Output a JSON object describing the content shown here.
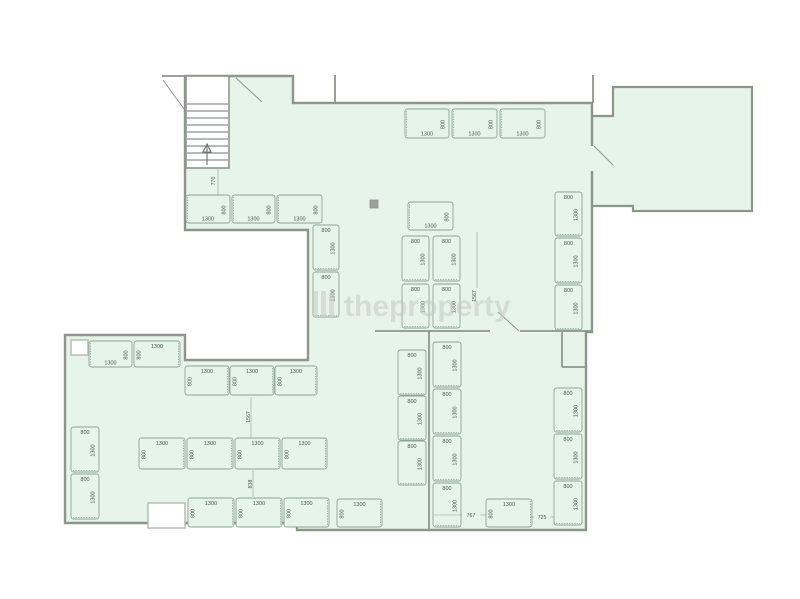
{
  "page": {
    "background": "#ffffff",
    "width": 800,
    "height": 599
  },
  "colors": {
    "floor": "#e6f4e9",
    "wall": "#8e958d",
    "wall_light": "#b4b9b1",
    "desk_stroke": "#8fa396",
    "label": "#4a5a50",
    "stair_line": "#6d7570",
    "watermark": "#c7cbc5",
    "column_fill": "#97a29b",
    "white": "#ffffff"
  },
  "watermark": {
    "text": "theproperty",
    "x": 344,
    "y": 316,
    "font_size": 30,
    "opacity": 0.55,
    "bars": [
      [
        313,
        291,
        5,
        26
      ],
      [
        321,
        291,
        5,
        26
      ],
      [
        329,
        293,
        5,
        24
      ]
    ]
  },
  "floorplan": {
    "main_outline": [
      [
        185,
        76
      ],
      [
        293,
        76
      ],
      [
        293,
        103
      ],
      [
        592,
        103
      ],
      [
        592,
        332
      ],
      [
        586,
        332
      ],
      [
        586,
        530
      ],
      [
        297,
        530
      ],
      [
        297,
        523
      ],
      [
        65,
        523
      ],
      [
        65,
        335
      ],
      [
        185,
        335
      ],
      [
        185,
        360
      ],
      [
        308,
        360
      ],
      [
        308,
        230
      ],
      [
        185,
        230
      ]
    ],
    "annex_outline": [
      [
        590,
        116
      ],
      [
        613,
        116
      ],
      [
        613,
        87
      ],
      [
        752,
        87
      ],
      [
        752,
        211
      ],
      [
        633,
        211
      ],
      [
        633,
        206
      ],
      [
        590,
        206
      ]
    ],
    "interior_walls": [
      [
        375,
        331,
        490,
        331
      ],
      [
        520,
        331,
        592,
        331
      ],
      [
        429,
        332,
        429,
        530
      ],
      [
        562,
        332,
        562,
        367
      ],
      [
        562,
        367,
        586,
        367
      ],
      [
        335,
        75,
        335,
        103
      ],
      [
        593,
        75,
        593,
        103
      ],
      [
        162,
        76,
        185,
        76
      ]
    ],
    "door_gap": {
      "x": 587,
      "y": 146,
      "w": 8,
      "h": 25
    },
    "doors": [
      [
        163,
        80,
        184,
        109
      ],
      [
        236,
        78,
        262,
        102
      ],
      [
        594,
        146,
        613,
        165
      ],
      [
        519,
        331,
        498,
        312
      ]
    ],
    "stairs": {
      "x": 186,
      "y": 76,
      "w": 43,
      "h": 92,
      "treads_from": 104,
      "tread_step": 7,
      "tread_count": 9,
      "arrow_x": 207,
      "arrow_y_tail": 165,
      "arrow_y_head": 146
    },
    "cutouts": [
      {
        "x": 148,
        "y": 503,
        "w": 37,
        "h": 25
      },
      {
        "x": 71,
        "y": 340,
        "w": 17,
        "h": 15
      }
    ],
    "column": {
      "x": 370,
      "y": 200,
      "w": 8,
      "h": 8
    },
    "desks": [
      {
        "x": 186,
        "y": 195,
        "w": 44,
        "h": 28,
        "o": "h",
        "lp": "bottom",
        "sp": "right",
        "l": "1300",
        "s": "800"
      },
      {
        "x": 232,
        "y": 195,
        "w": 43,
        "h": 28,
        "o": "h",
        "lp": "bottom",
        "sp": "right",
        "l": "1300",
        "s": "800"
      },
      {
        "x": 277,
        "y": 195,
        "w": 45,
        "h": 28,
        "o": "h",
        "lp": "bottom",
        "sp": "right",
        "l": "1300",
        "s": "800"
      },
      {
        "x": 405,
        "y": 109,
        "w": 44,
        "h": 29,
        "o": "h",
        "lp": "bottom",
        "sp": "right",
        "l": "1300",
        "s": "800"
      },
      {
        "x": 452,
        "y": 109,
        "w": 45,
        "h": 29,
        "o": "h",
        "lp": "bottom",
        "sp": "right",
        "l": "1300",
        "s": "800"
      },
      {
        "x": 500,
        "y": 109,
        "w": 45,
        "h": 29,
        "o": "h",
        "lp": "bottom",
        "sp": "right",
        "l": "1300",
        "s": "800"
      },
      {
        "x": 408,
        "y": 202,
        "w": 45,
        "h": 28,
        "o": "h",
        "lp": "bottom",
        "sp": "right",
        "l": "1300",
        "s": "800"
      },
      {
        "x": 89,
        "y": 341,
        "w": 43,
        "h": 26,
        "o": "h",
        "lp": "bottom",
        "sp": "right",
        "l": "1300",
        "s": "800"
      },
      {
        "x": 134,
        "y": 341,
        "w": 46,
        "h": 26,
        "o": "h",
        "lp": "top",
        "sp": "left",
        "l": "1300",
        "s": "800"
      },
      {
        "x": 185,
        "y": 366,
        "w": 44,
        "h": 29,
        "o": "h",
        "lp": "top",
        "sp": "left",
        "l": "1300",
        "s": "800"
      },
      {
        "x": 230,
        "y": 366,
        "w": 44,
        "h": 29,
        "o": "h",
        "lp": "top",
        "sp": "left",
        "l": "1300",
        "s": "800"
      },
      {
        "x": 275,
        "y": 366,
        "w": 42,
        "h": 29,
        "o": "h",
        "lp": "top",
        "sp": "left",
        "l": "1300",
        "s": "800"
      },
      {
        "x": 139,
        "y": 438,
        "w": 46,
        "h": 31,
        "o": "h",
        "lp": "top",
        "sp": "left",
        "l": "1300",
        "s": "800"
      },
      {
        "x": 187,
        "y": 438,
        "w": 46,
        "h": 31,
        "o": "h",
        "lp": "top",
        "sp": "left",
        "l": "1300",
        "s": "800"
      },
      {
        "x": 235,
        "y": 438,
        "w": 45,
        "h": 31,
        "o": "h",
        "lp": "top",
        "sp": "left",
        "l": "1300",
        "s": "800"
      },
      {
        "x": 282,
        "y": 438,
        "w": 45,
        "h": 31,
        "o": "h",
        "lp": "top",
        "sp": "left",
        "l": "1300",
        "s": "800"
      },
      {
        "x": 188,
        "y": 498,
        "w": 46,
        "h": 29,
        "o": "h",
        "lp": "top",
        "sp": "left",
        "l": "1300",
        "s": "800"
      },
      {
        "x": 236,
        "y": 498,
        "w": 46,
        "h": 29,
        "o": "h",
        "lp": "top",
        "sp": "left",
        "l": "1300",
        "s": "800"
      },
      {
        "x": 284,
        "y": 498,
        "w": 45,
        "h": 29,
        "o": "h",
        "lp": "top",
        "sp": "left",
        "l": "1300",
        "s": "800"
      },
      {
        "x": 337,
        "y": 499,
        "w": 45,
        "h": 28,
        "o": "h",
        "lp": "top",
        "sp": "left",
        "l": "1300",
        "s": "800"
      },
      {
        "x": 486,
        "y": 499,
        "w": 46,
        "h": 28,
        "o": "h",
        "lp": "top",
        "sp": "left",
        "l": "1300",
        "s": "800"
      },
      {
        "x": 313,
        "y": 225,
        "w": 26,
        "h": 45,
        "o": "v",
        "lp": "right",
        "sp": "top",
        "l": "1300",
        "s": "800"
      },
      {
        "x": 313,
        "y": 272,
        "w": 26,
        "h": 45,
        "o": "v",
        "lp": "right",
        "sp": "top",
        "l": "1300",
        "s": "800"
      },
      {
        "x": 402,
        "y": 236,
        "w": 27,
        "h": 45,
        "o": "v",
        "lp": "right",
        "sp": "top",
        "l": "1300",
        "s": "800"
      },
      {
        "x": 433,
        "y": 236,
        "w": 27,
        "h": 45,
        "o": "v",
        "lp": "right",
        "sp": "top",
        "l": "1300",
        "s": "800"
      },
      {
        "x": 402,
        "y": 284,
        "w": 27,
        "h": 44,
        "o": "v",
        "lp": "right",
        "sp": "top",
        "l": "1300",
        "s": "800"
      },
      {
        "x": 433,
        "y": 284,
        "w": 27,
        "h": 44,
        "o": "v",
        "lp": "right",
        "sp": "top",
        "l": "1300",
        "s": "800"
      },
      {
        "x": 555,
        "y": 192,
        "w": 27,
        "h": 44,
        "o": "v",
        "lp": "right",
        "sp": "top",
        "l": "1300",
        "s": "800"
      },
      {
        "x": 555,
        "y": 238,
        "w": 27,
        "h": 45,
        "o": "v",
        "lp": "right",
        "sp": "top",
        "l": "1300",
        "s": "800"
      },
      {
        "x": 555,
        "y": 285,
        "w": 27,
        "h": 45,
        "o": "v",
        "lp": "right",
        "sp": "top",
        "l": "1300",
        "s": "800"
      },
      {
        "x": 71,
        "y": 427,
        "w": 28,
        "h": 45,
        "o": "v",
        "lp": "right",
        "sp": "top",
        "l": "1300",
        "s": "800"
      },
      {
        "x": 71,
        "y": 474,
        "w": 28,
        "h": 45,
        "o": "v",
        "lp": "right",
        "sp": "top",
        "l": "1300",
        "s": "800"
      },
      {
        "x": 398,
        "y": 350,
        "w": 28,
        "h": 45,
        "o": "v",
        "lp": "right",
        "sp": "top",
        "l": "1300",
        "s": "800"
      },
      {
        "x": 398,
        "y": 396,
        "w": 28,
        "h": 44,
        "o": "v",
        "lp": "right",
        "sp": "top",
        "l": "1300",
        "s": "800"
      },
      {
        "x": 398,
        "y": 441,
        "w": 28,
        "h": 44,
        "o": "v",
        "lp": "right",
        "sp": "top",
        "l": "1300",
        "s": "800"
      },
      {
        "x": 433,
        "y": 342,
        "w": 28,
        "h": 45,
        "o": "v",
        "lp": "right",
        "sp": "top",
        "l": "1300",
        "s": "800"
      },
      {
        "x": 433,
        "y": 389,
        "w": 28,
        "h": 45,
        "o": "v",
        "lp": "right",
        "sp": "top",
        "l": "1300",
        "s": "800"
      },
      {
        "x": 433,
        "y": 436,
        "w": 28,
        "h": 45,
        "o": "v",
        "lp": "right",
        "sp": "top",
        "l": "1300",
        "s": "800"
      },
      {
        "x": 433,
        "y": 483,
        "w": 28,
        "h": 44,
        "o": "v",
        "lp": "right",
        "sp": "top",
        "l": "1300",
        "s": "800"
      },
      {
        "x": 554,
        "y": 388,
        "w": 28,
        "h": 44,
        "o": "v",
        "lp": "right",
        "sp": "top",
        "l": "1300",
        "s": "800"
      },
      {
        "x": 554,
        "y": 434,
        "w": 28,
        "h": 45,
        "o": "v",
        "lp": "right",
        "sp": "top",
        "l": "1300",
        "s": "800"
      },
      {
        "x": 554,
        "y": 481,
        "w": 28,
        "h": 44,
        "o": "v",
        "lp": "right",
        "sp": "top",
        "l": "1300",
        "s": "800"
      }
    ],
    "dims": [
      {
        "text": "770",
        "x": 215,
        "y": 181,
        "rot": true
      },
      {
        "text": "1567",
        "x": 476,
        "y": 296,
        "rot": true
      },
      {
        "text": "1567",
        "x": 250,
        "y": 417,
        "rot": true
      },
      {
        "text": "838",
        "x": 252,
        "y": 484,
        "rot": true
      },
      {
        "text": "767",
        "x": 471,
        "y": 517,
        "rot": false
      },
      {
        "text": "725",
        "x": 542,
        "y": 519,
        "rot": false
      }
    ],
    "dim_lines": [
      [
        218,
        168,
        218,
        196
      ],
      [
        477,
        232,
        477,
        288
      ],
      [
        251,
        397,
        251,
        437
      ],
      [
        253,
        470,
        253,
        497
      ],
      [
        434,
        515,
        462,
        515
      ],
      [
        480,
        515,
        486,
        515
      ],
      [
        530,
        517,
        534,
        517
      ],
      [
        550,
        517,
        554,
        517
      ]
    ]
  }
}
